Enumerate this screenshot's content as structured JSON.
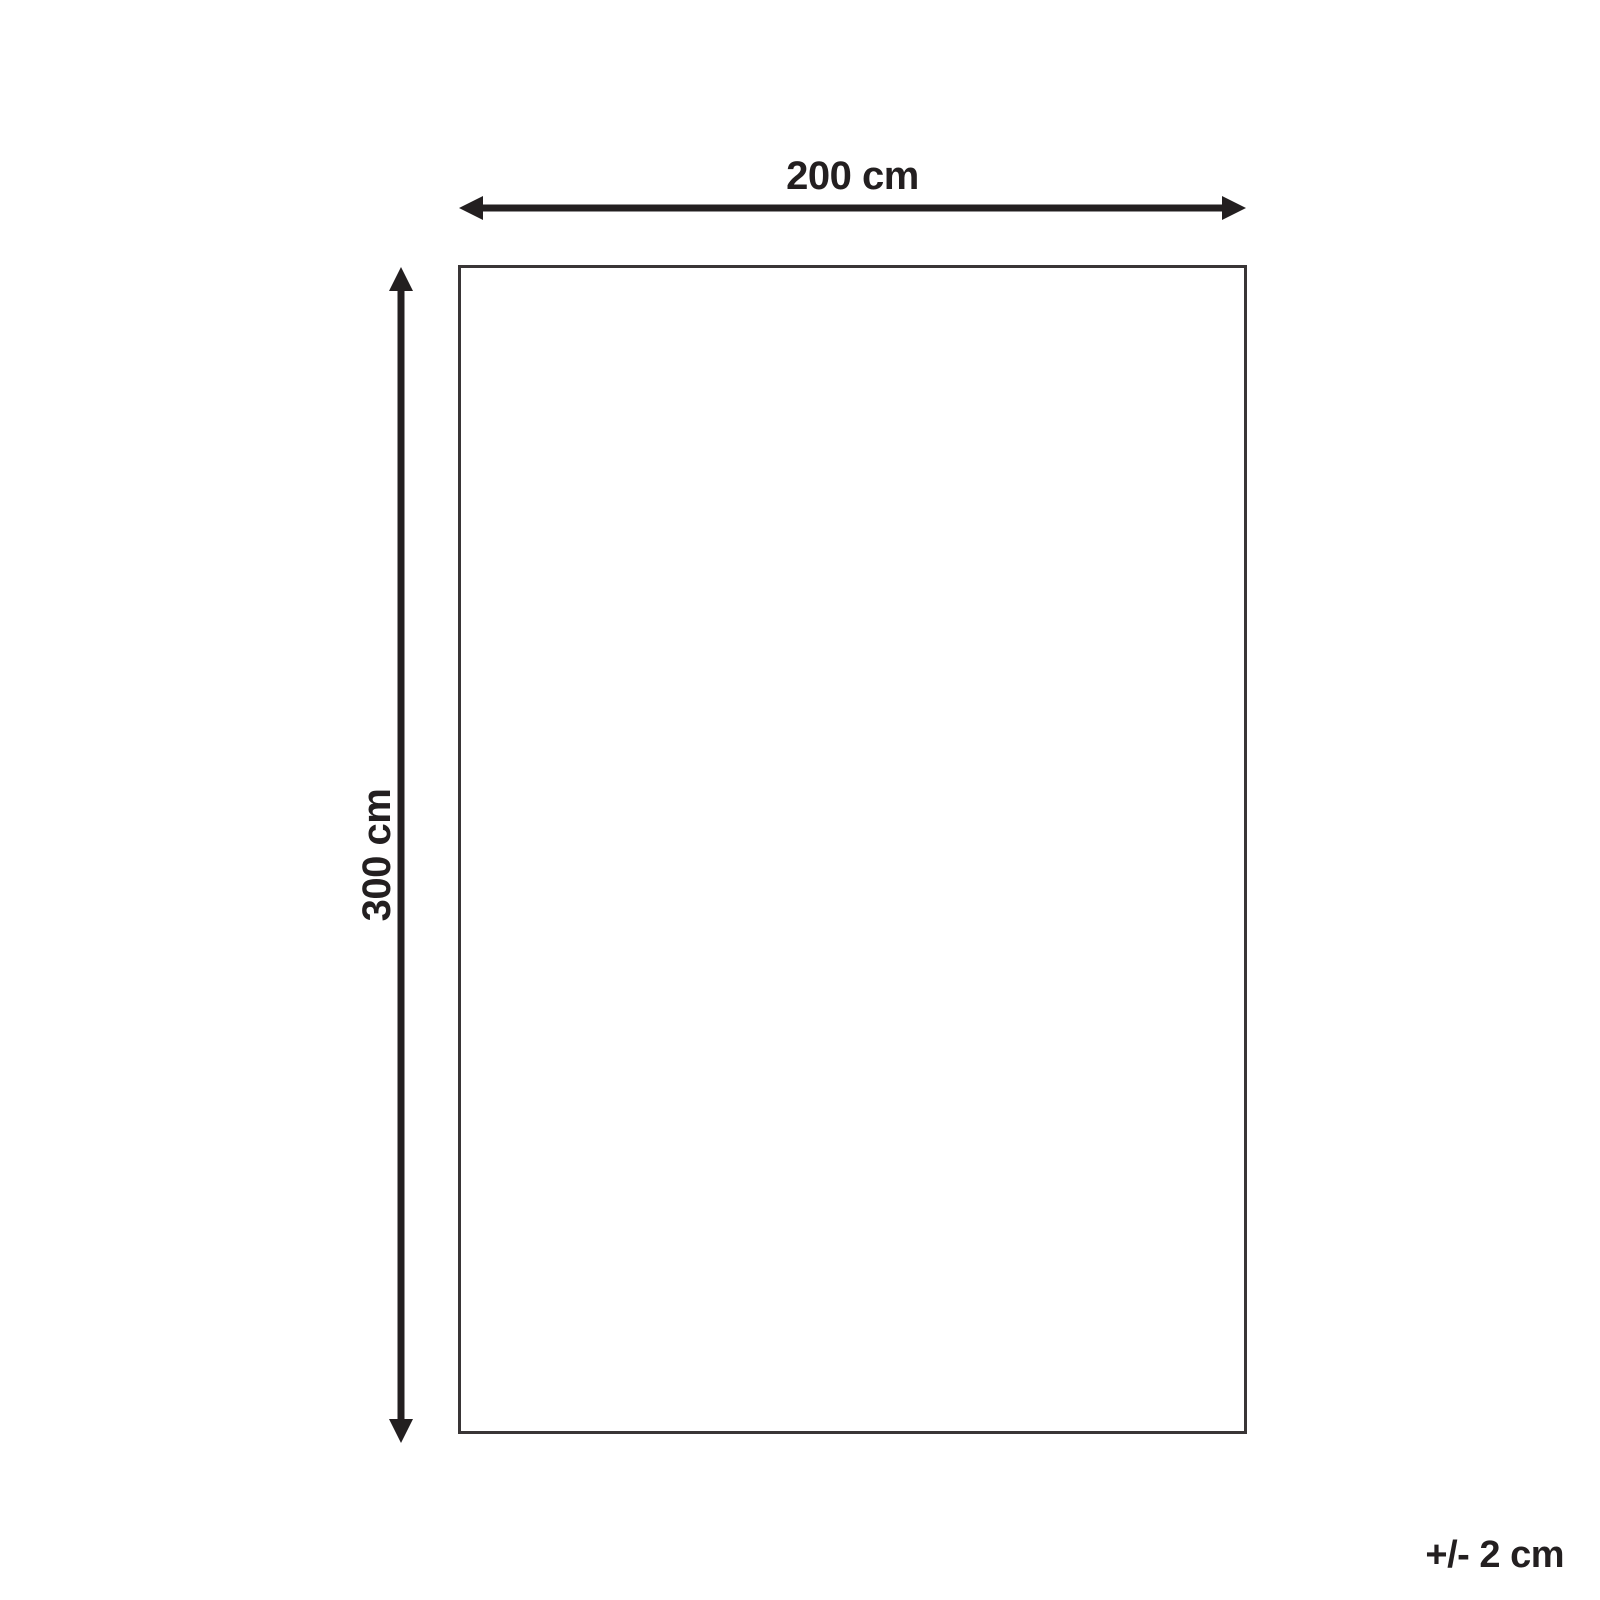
{
  "page": {
    "background_color": "#ffffff",
    "line_color": "#231f20",
    "rect_border_color": "#393536"
  },
  "diagram": {
    "type": "product-dimension-diagram",
    "shape": "rectangle",
    "width_label": "200 cm",
    "height_label": "300 cm",
    "tolerance_label": "+/- 2 cm",
    "width_value_cm": 200,
    "height_value_cm": 300,
    "tolerance_value_cm": 2
  }
}
